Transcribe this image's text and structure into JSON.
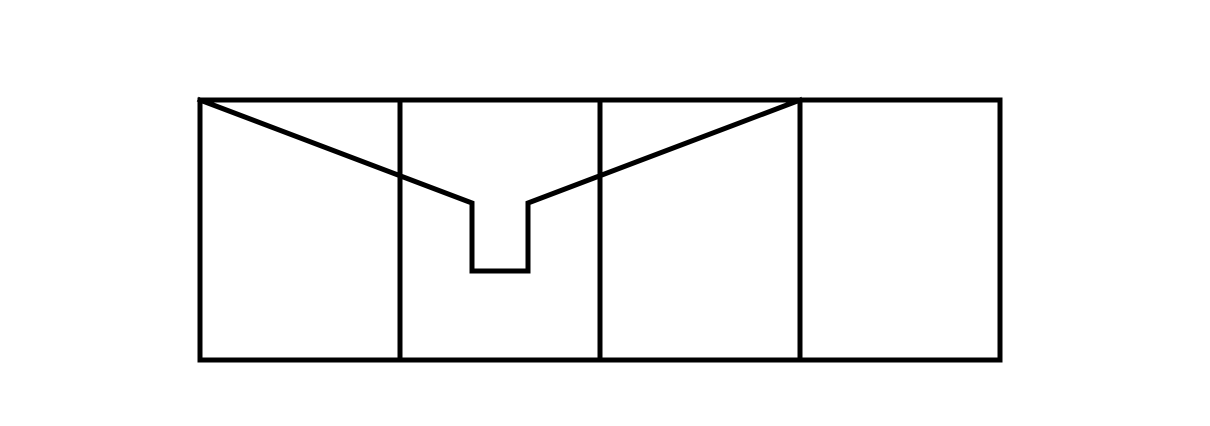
{
  "canvas": {
    "width": 1210,
    "height": 426,
    "background_color": "#ffffff"
  },
  "drawing": {
    "description": "Line drawing: wide rectangle split into four panels by three vertical dividers, with an envelope-flap polyline running from the top-left corner down to a small rectangular notch in the second panel and back up to the top edge at the third divider.",
    "stroke_color": "#000000",
    "stroke_width": 5,
    "outer_rectangle": {
      "x": 200,
      "y": 100,
      "width": 800,
      "height": 260
    },
    "vertical_dividers": [
      {
        "x": 400
      },
      {
        "x": 600
      },
      {
        "x": 800
      }
    ],
    "flap_polyline": {
      "points": [
        [
          200,
          100
        ],
        [
          472,
          203
        ],
        [
          472,
          271
        ],
        [
          528,
          271
        ],
        [
          528,
          203
        ],
        [
          800,
          100
        ]
      ]
    }
  }
}
